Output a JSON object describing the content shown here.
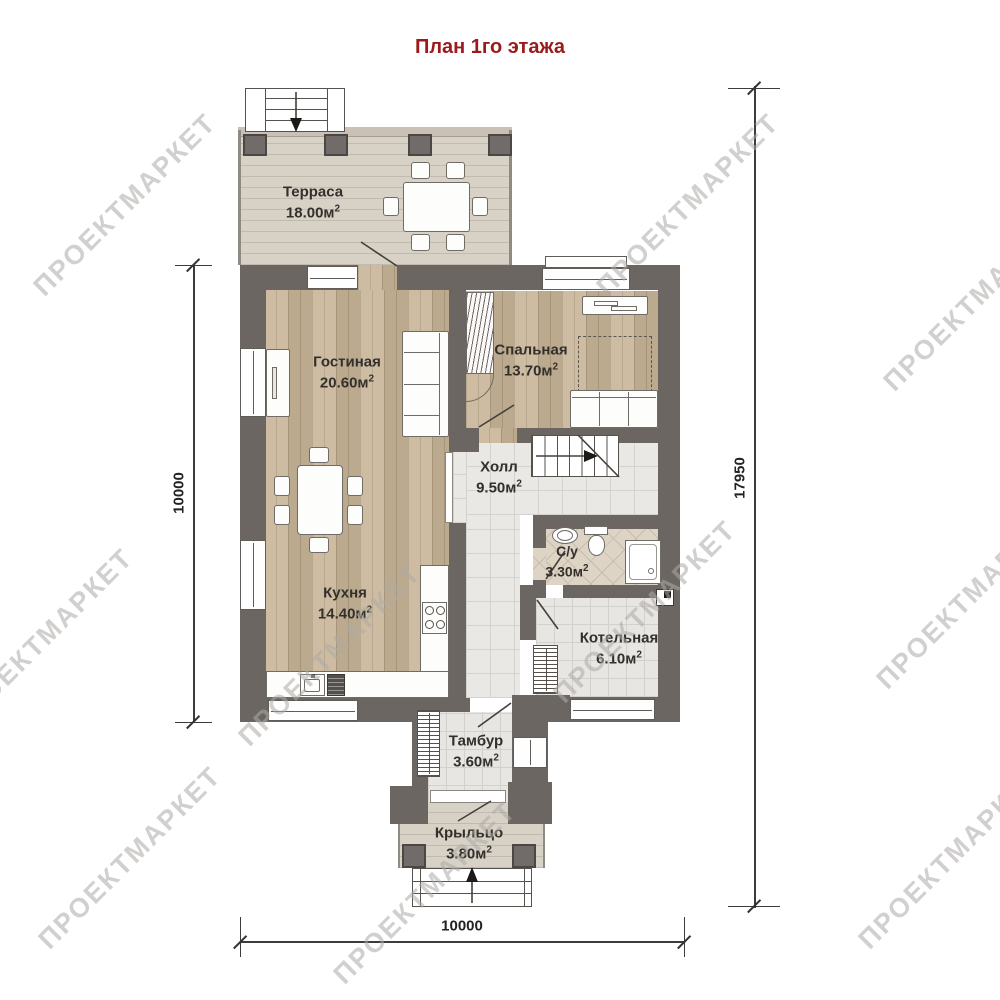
{
  "title": "План 1го этажа",
  "watermark_text": "ПРОЕКТМАРКЕТ",
  "rooms": {
    "terrace": {
      "name": "Терраса",
      "area": "18.00м",
      "sup": "2"
    },
    "living": {
      "name": "Гостиная",
      "area": "20.60м",
      "sup": "2"
    },
    "bedroom": {
      "name": "Спальная",
      "area": "13.70м",
      "sup": "2"
    },
    "hall": {
      "name": "Холл",
      "area": "9.50м",
      "sup": "2"
    },
    "kitchen": {
      "name": "Кухня",
      "area": "14.40м",
      "sup": "2"
    },
    "bathroom": {
      "name": "С/у",
      "area": "3.30м",
      "sup": "2"
    },
    "boiler": {
      "name": "Котельная",
      "area": "6.10м",
      "sup": "2"
    },
    "vestibule": {
      "name": "Тамбур",
      "area": "3.60м",
      "sup": "2"
    },
    "porch": {
      "name": "Крыльцо",
      "area": "3.80м",
      "sup": "2"
    }
  },
  "dimensions": {
    "left": "10000",
    "right": "17950",
    "bottom": "10000"
  },
  "colors": {
    "title": "#9b1b1b",
    "wall": "#6b6662",
    "wood_floor": "#c8b598",
    "deck": "#d8d1c6",
    "tile": "#e9e8e5",
    "bath_tile": "#ddd4c6"
  }
}
